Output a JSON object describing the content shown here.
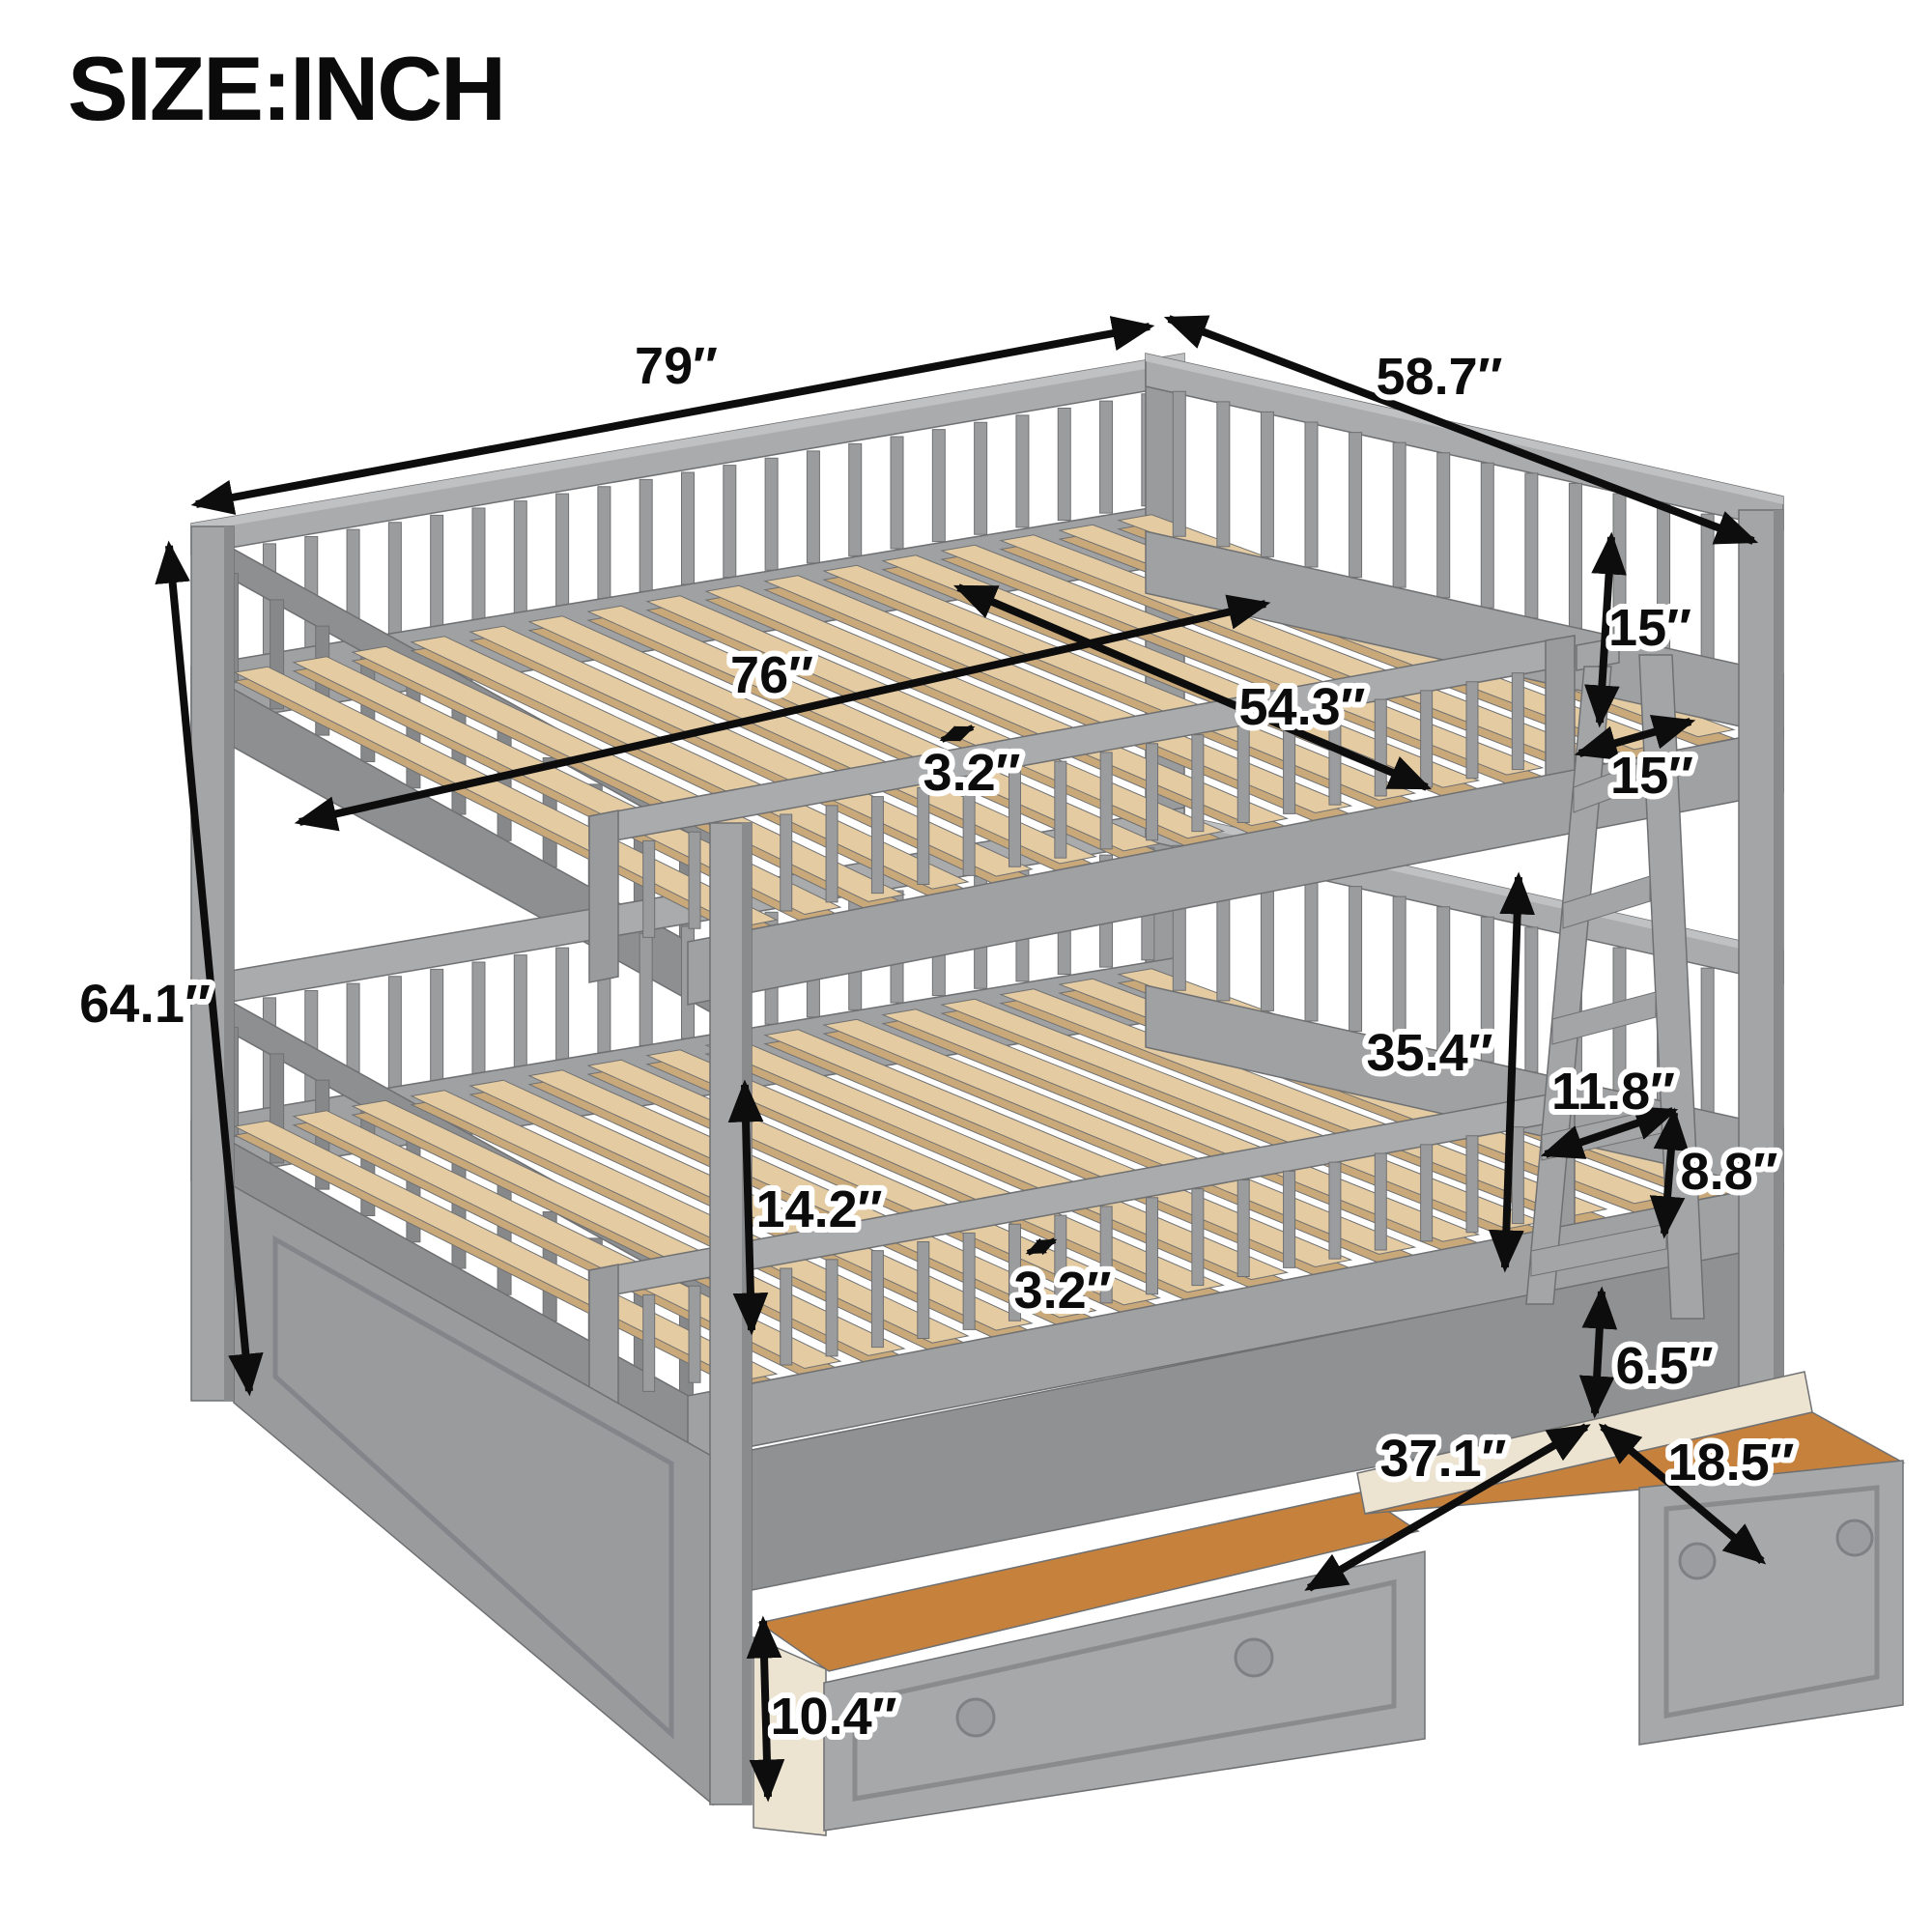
{
  "title": "SIZE:INCH",
  "dims": {
    "overall_length": "79″",
    "overall_width": "58.7″",
    "interior_length": "76″",
    "interior_width": "54.3″",
    "slat_gap_top": "3.2″",
    "guardrail_height": "15″",
    "ladder_opening": "15″",
    "overall_height": "64.1″",
    "bunk_clearance": "35.4″",
    "ladder_step_width": "11.8″",
    "rung_spacing": "8.8″",
    "lower_rail_height": "14.2″",
    "slat_gap_bottom": "3.2″",
    "drawer_clearance": "6.5″",
    "drawer_length": "37.1″",
    "drawer_depth": "18.5″",
    "drawer_height": "10.4″"
  },
  "colors": {
    "frame_gray": "#a0a1a3",
    "frame_gray_dark": "#87888a",
    "frame_gray_light": "#b9babc",
    "slat_wood": "#e4cba1",
    "slat_wood_side": "#c9a97a",
    "drawer_interior": "#c6813d",
    "drawer_side": "#ece3d1",
    "dimension_line": "#0d0d0d",
    "background": "#ffffff"
  }
}
